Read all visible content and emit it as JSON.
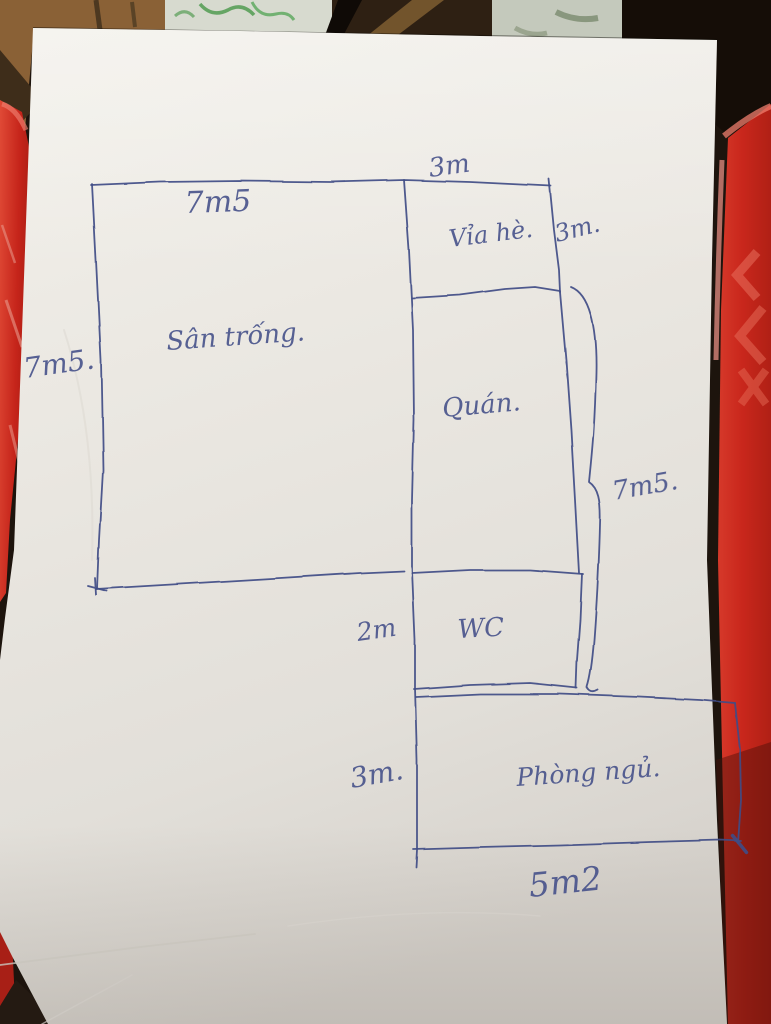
{
  "sketch": {
    "rooms": [
      {
        "id": "san-trong",
        "label": "Sân trống."
      },
      {
        "id": "via-he",
        "label": "Vỉa hè."
      },
      {
        "id": "quan",
        "label": "Quán."
      },
      {
        "id": "wc",
        "label": "WC"
      },
      {
        "id": "phong-ngu",
        "label": "Phòng ngủ."
      }
    ],
    "dimensions": [
      {
        "id": "san-trong-width-top",
        "label": "7m5"
      },
      {
        "id": "san-trong-height-left",
        "label": "7m5."
      },
      {
        "id": "via-he-width-top",
        "label": "3m"
      },
      {
        "id": "via-he-height-right",
        "label": "3m."
      },
      {
        "id": "quan-height-right",
        "label": "7m5."
      },
      {
        "id": "wc-height-left",
        "label": "2m"
      },
      {
        "id": "phong-ngu-height-left",
        "label": "3m."
      },
      {
        "id": "phong-ngu-width-bottom",
        "label": "5m2"
      }
    ],
    "pen_color": "#404d85"
  },
  "palette": {
    "paper": "#e9e6e0",
    "stool_red": "#cb2a1e",
    "wood_floor": "#8a6132",
    "plastic_bag": "#d7dacf",
    "bag_print_green": "#3f9340",
    "background_dark": "#1d140d"
  }
}
